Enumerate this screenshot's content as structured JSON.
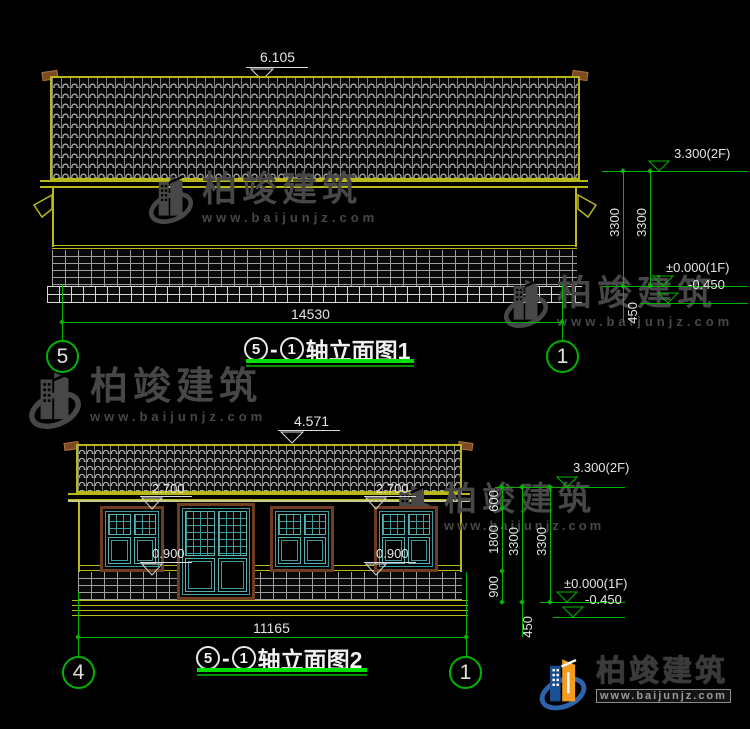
{
  "colors": {
    "cad_yellow": "#b8b81c",
    "dim_green": "#00b400",
    "underline_green": "#00dd00",
    "window_teal": "#3f9b9b",
    "frame_brown": "#6e3c1e",
    "watermark_gray": "#474747",
    "logo_blue": "#2e64ad",
    "logo_dark_blue": "#1c4e92",
    "logo_orange": "#f59b1f"
  },
  "elevation1": {
    "title": {
      "axis_a": "5",
      "sep": "-",
      "axis_b": "1",
      "label": "轴立面图1"
    },
    "axis_left": "5",
    "axis_right": "1",
    "dims": {
      "ridge": "6.105",
      "width": "14530",
      "floor_height_a": "3300",
      "floor_height_b": "3300",
      "base": "450"
    },
    "levels": {
      "second_floor": "3.300(2F)",
      "ground_floor": "±0.000(1F)",
      "below_ground": "-0.450"
    }
  },
  "elevation2": {
    "title": {
      "axis_a": "5",
      "sep": "-",
      "axis_b": "1",
      "label": "轴立面图2"
    },
    "axis_left": "4",
    "axis_right": "1",
    "dims": {
      "ridge": "4.571",
      "width": "11165",
      "lintel_left": "2.700",
      "lintel_right": "2.700",
      "sill_left": "0.900",
      "sill_right": "0.900",
      "eave_offset": "600",
      "window_height": "1800",
      "sill_height": "900",
      "floor_height_a": "3300",
      "floor_height_b": "3300",
      "base": "450"
    },
    "levels": {
      "second_floor": "3.300(2F)",
      "ground_floor": "±0.000(1F)",
      "below_ground": "-0.450"
    }
  },
  "watermark": {
    "company": "柏竣建筑",
    "website": "www.baijunjz.com"
  },
  "brand_logo": {
    "company": "柏竣建筑",
    "website": "www.baijunjz.com"
  }
}
